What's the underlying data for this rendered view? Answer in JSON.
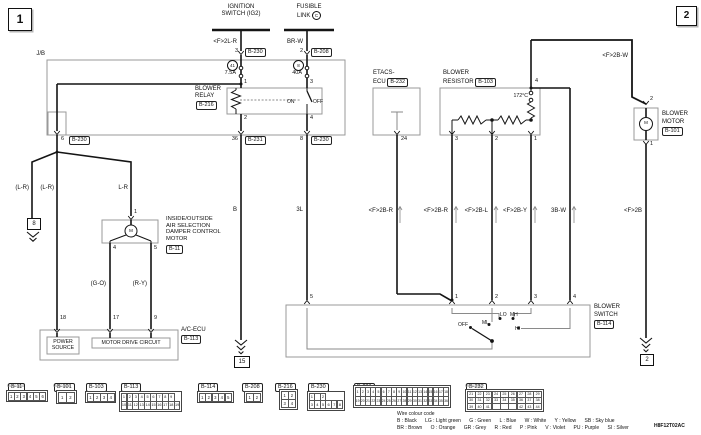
{
  "sheet": {
    "left_tag": "1",
    "right_tag": "2",
    "doc_code": "H8F12T02AC"
  },
  "symbols": {
    "motor": "M"
  },
  "power": {
    "ignition": {
      "l1": "IGNITION",
      "l2": "SWITCH (IG2)",
      "wire": "<F>2L-R",
      "pin": "3",
      "conn": "B-230"
    },
    "fusible": {
      "l1": "FUSIBLE",
      "l2": "LINK",
      "link_id": "C",
      "wire": "BR-W",
      "pin": "2",
      "conn": "B-208"
    }
  },
  "jb": {
    "label": "J/B",
    "fuse41": {
      "no": "41",
      "amp": "7.5A"
    },
    "fuse8": {
      "no": "8",
      "amp": "40A"
    },
    "relay": {
      "l1": "BLOWER",
      "l2": "RELAY",
      "conn": "B-216",
      "p1": "1",
      "p2": "2",
      "p3": "3",
      "p4": "4",
      "on": "ON",
      "off": "OFF"
    },
    "out_left": {
      "pin": "6",
      "conn": "B-230"
    },
    "out_coil": {
      "pin": "36",
      "conn": "B-231"
    },
    "out_motor": {
      "pin": "8",
      "conn": "B-230"
    }
  },
  "left": {
    "wire_gnd": "(L-R)",
    "wire_mid": "(L-R)",
    "wire_motor": "L-R",
    "ref8": "8",
    "damper": {
      "l1": "INSIDE/OUTSIDE",
      "l2": "AIR SELECTION",
      "l3": "DAMPER CONTROL",
      "l4": "MOTOR",
      "conn": "B-11",
      "p1": "1",
      "p4": "4",
      "p5": "5"
    },
    "wire_go": "(G-O)",
    "wire_ry": "(R-Y)",
    "acecu": {
      "p18": "18",
      "p17": "17",
      "p9": "9",
      "name": "A/C-ECU",
      "conn": "B-113",
      "ps1": "POWER",
      "ps2": "SOURCE",
      "mdc": "MOTOR DRIVE CIRCUIT"
    }
  },
  "mid": {
    "wire_b": "B",
    "gnd15": "15",
    "wire_3l": "3L"
  },
  "right": {
    "etacs": {
      "l1": "ETACS-",
      "l2": "ECU",
      "conn": "B-232",
      "pin": "24",
      "wire": "<F>2B-R"
    },
    "resistor": {
      "l1": "BLOWER",
      "l2": "RESISTOR",
      "conn": "B-103",
      "temp": "172°C",
      "p4": "4",
      "p3": "3",
      "p2": "2",
      "p1": "1"
    },
    "wires": {
      "w3": "<F>2B-R",
      "w2": "<F>2B-L",
      "w1": "<F>2B-Y",
      "hi": "3B-W",
      "motor_gnd": "<F>2B",
      "motor_feed": "<F>2B-W"
    },
    "motor": {
      "l1": "BLOWER",
      "l2": "MOTOR",
      "conn": "B-101",
      "p2": "2",
      "p1": "1"
    },
    "switch": {
      "l1": "BLOWER",
      "l2": "SWITCH",
      "conn": "B-114",
      "p1": "1",
      "p2": "2",
      "p3": "3",
      "p4": "4",
      "p5": "5",
      "off": "OFF",
      "lo": "LO",
      "ml": "ML",
      "mh": "MH",
      "hi": "HI"
    },
    "gnd2": "2"
  },
  "connectors": [
    {
      "id": "B-11",
      "code": "MU801648",
      "rows": [
        [
          "1",
          "2",
          "3",
          "4",
          "5",
          "6"
        ]
      ]
    },
    {
      "id": "B-101",
      "code": "MU801325",
      "rows": [
        [
          "1",
          "2"
        ]
      ]
    },
    {
      "id": "B-103",
      "code": "",
      "rows": [
        [
          "1",
          "2",
          "3",
          "4"
        ]
      ]
    },
    {
      "id": "B-113",
      "code": "",
      "rows": [
        [
          "1",
          "2",
          "3",
          "4",
          "5",
          "6",
          "7",
          "8",
          "9"
        ],
        [
          "10",
          "11",
          "12",
          "13",
          "14",
          "15",
          "16",
          "17",
          "18",
          "19"
        ]
      ]
    },
    {
      "id": "B-114",
      "code": "",
      "rows": [
        [
          "1",
          "2",
          "3",
          "4",
          "5"
        ]
      ]
    },
    {
      "id": "B-208",
      "code": "",
      "rows": [
        [
          "1",
          "2"
        ]
      ]
    },
    {
      "id": "B-216",
      "code": "",
      "rows": [
        [
          "1",
          "2"
        ],
        [
          "3",
          "4"
        ]
      ]
    },
    {
      "id": "B-230",
      "code": "",
      "rows": [
        [
          "1",
          "",
          "2"
        ],
        [
          "3",
          "4",
          "5",
          "6",
          "7",
          "8"
        ]
      ]
    },
    {
      "id": "B-231",
      "code": "",
      "rows": [
        [
          "1",
          "2",
          "3",
          "4",
          "5",
          "6",
          "7",
          "8",
          "9",
          "10",
          "11",
          "12",
          "13",
          "14",
          "15",
          "16",
          "17",
          "18"
        ],
        [
          "19",
          "20",
          "21",
          "22",
          "23",
          "24",
          "25",
          "26",
          "27",
          "28",
          "29",
          "30",
          "31",
          "32",
          "33",
          "34",
          "35",
          "36"
        ]
      ]
    },
    {
      "id": "B-232",
      "code": "MB803760",
      "rows": [
        [
          "21",
          "22",
          "23",
          "24",
          "25",
          "26",
          "27",
          "28",
          "29"
        ],
        [
          "30",
          "31",
          "32",
          "33",
          "34",
          "35",
          "36",
          "37",
          "38"
        ],
        [
          "39",
          "40",
          "41",
          "",
          "",
          "",
          "42",
          "43",
          "44"
        ]
      ]
    }
  ],
  "legend": {
    "title": "Wire colour code",
    "row1": "B : Black      LG : Light green      G : Green      L : Blue      W : White      Y : Yellow      SB : Sky blue",
    "row2": "BR : Brown      O : Orange      GR : Grey      R : Red      P : Pink      V : Violet      PU : Purple      SI : Silver"
  }
}
